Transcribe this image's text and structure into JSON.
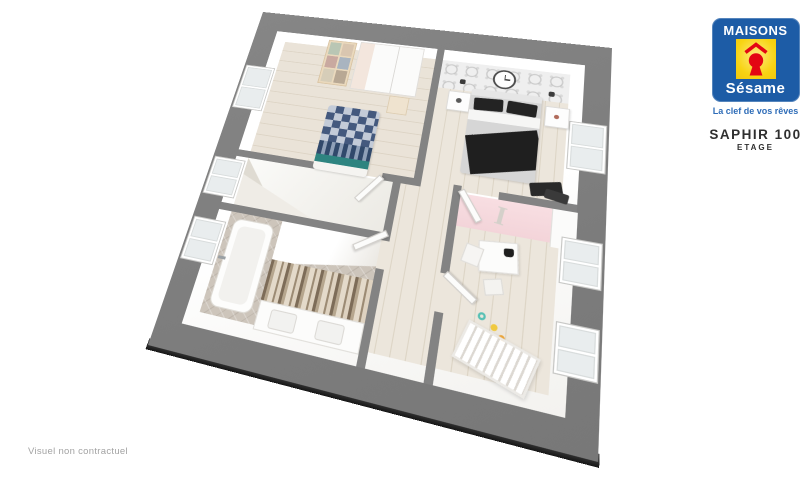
{
  "brand": {
    "maisons_label": "MAISONS",
    "sesame_label": "Sésame",
    "tagline": "La clef de vos rêves"
  },
  "product": {
    "name": "SAPHIR 100",
    "floor_label": "ETAGE"
  },
  "footnote": "Visuel non contractuel",
  "plan": {
    "decor_letter": "I"
  },
  "colors": {
    "mat_gray": "#7e7e7e",
    "wall_gray": "#838383",
    "slab_dark": "#1f1f1f",
    "wood_floor": "#eae3d8",
    "wood_plank_line": "#dcd3c4",
    "bathroom_tile": "#cdc5bb",
    "pink_wall": "#f6dade",
    "wallpaper_gray": "#efefef",
    "bed_navy": "#44597e",
    "bed_light": "#c3cbd8",
    "bed_teal": "#2e8480",
    "logo_blue": "#1d5ca6",
    "logo_yellow": "#f8d312",
    "logo_red": "#e30613",
    "tagline_blue": "#2f6db8",
    "title_dark": "#2f2f2f",
    "footnote_gray": "#a3a3a3"
  }
}
